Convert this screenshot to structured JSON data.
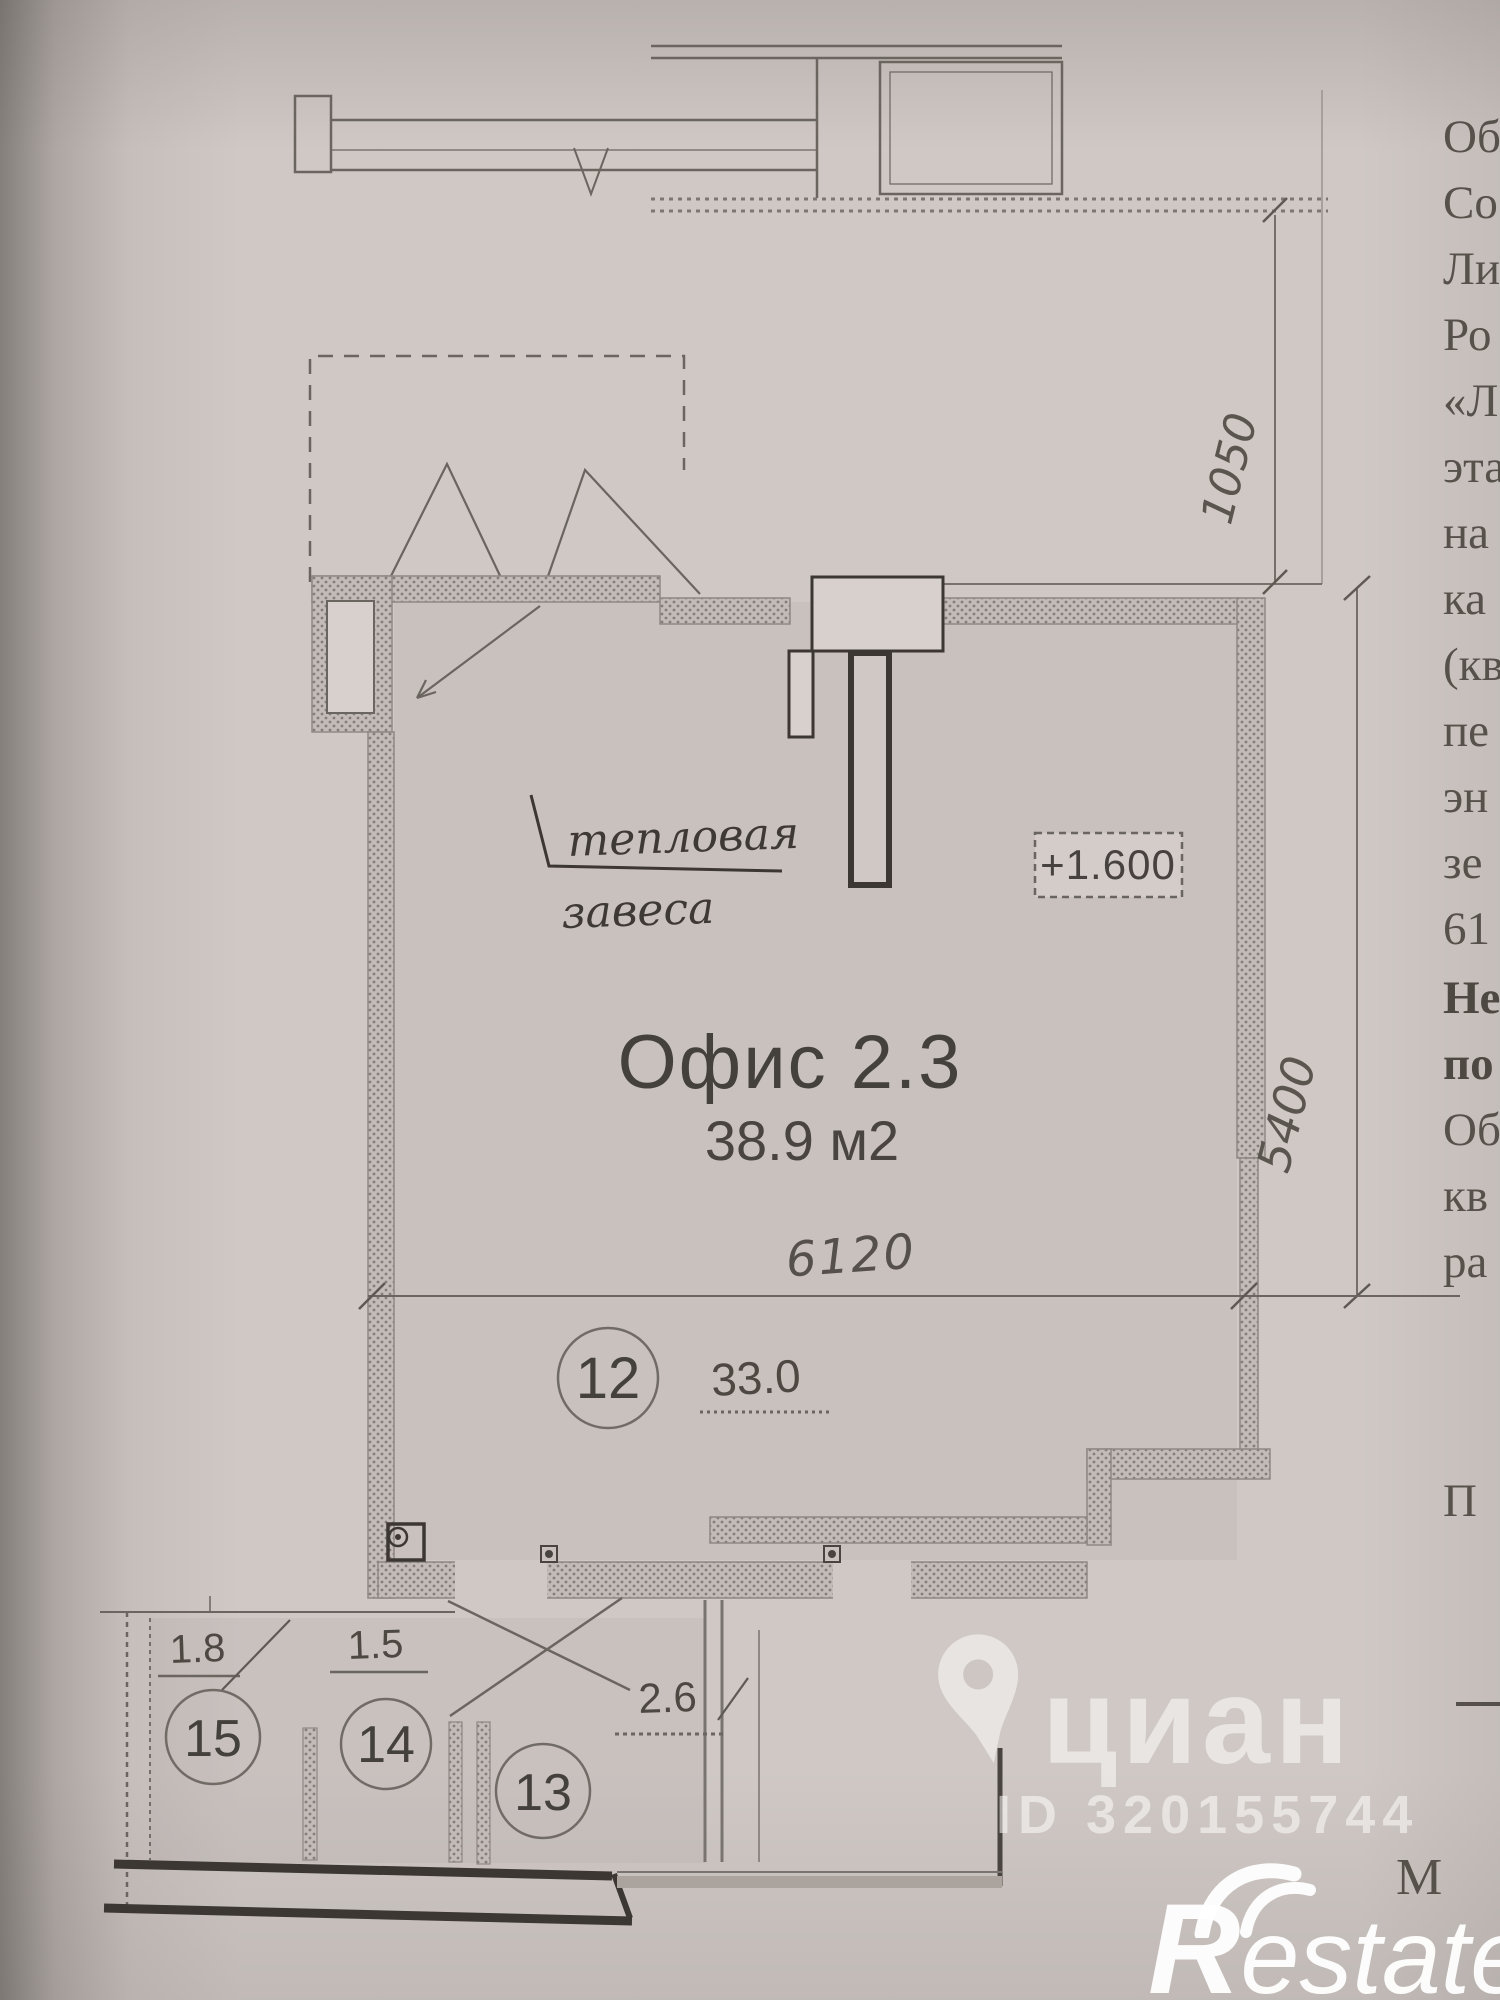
{
  "plan": {
    "title": "Офис 2.3",
    "area": "38.9 м2",
    "thermal_curtain_line1": "тепловая",
    "thermal_curtain_line2": "завеса",
    "elevation_mark": "+1.600",
    "dims": {
      "top_right_vertical": "1050",
      "right_vertical": "5400",
      "room_width": "6120",
      "room12_area": "33.0",
      "room15": "1.8",
      "room14": "1.5",
      "hall": "2.6"
    },
    "rooms": {
      "r12": "12",
      "r13": "13",
      "r14": "14",
      "r15": "15"
    }
  },
  "watermarks": {
    "cian_label": "циан",
    "cian_id": "ID 320155744",
    "restate_r": "R",
    "restate_suffix": "estate"
  },
  "doc_column": {
    "lines": [
      {
        "t": "Об"
      },
      {
        "t": "Со"
      },
      {
        "t": "Ли"
      },
      {
        "t": "Ро"
      },
      {
        "t": "«Л"
      },
      {
        "t": "эта"
      },
      {
        "t": "на"
      },
      {
        "t": "ка"
      },
      {
        "t": "(кв"
      },
      {
        "t": "пе"
      },
      {
        "t": "эн"
      },
      {
        "t": "зе"
      },
      {
        "t": "61"
      },
      {
        "t": "Не"
      },
      {
        "t": "по"
      },
      {
        "t": "Об"
      },
      {
        "t": "кв"
      },
      {
        "t": "ра"
      },
      {
        "t": "П"
      },
      {
        "t": "М"
      }
    ]
  },
  "colors": {
    "paper": "#cfc8c4",
    "ink_dark": "#3c3733",
    "ink_line": "#6b6560",
    "wall": "#8f8884",
    "watermark": "#ffffff"
  }
}
